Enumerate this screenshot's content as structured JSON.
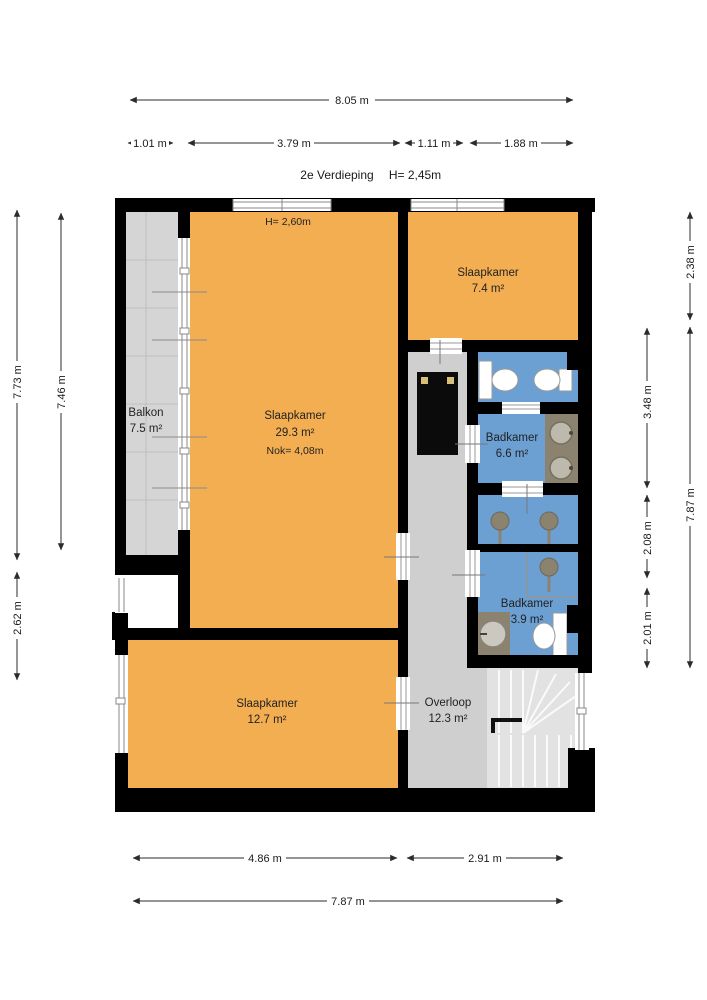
{
  "title": {
    "floor_label": "2e Verdieping",
    "ceiling_height": "H= 2,45m"
  },
  "dimensions": {
    "top_total": "8.05 m",
    "top_seg1": "1.01 m",
    "top_seg2": "3.79 m",
    "top_seg3": "1.11 m",
    "top_seg4": "1.88 m",
    "left_outer": "7.73 m",
    "left_inner": "7.46 m",
    "left_lower": "2.62 m",
    "right_top": "2.38 m",
    "right_outer": "7.87 m",
    "right_inner_top": "3.48 m",
    "right_inner_mid": "2.08 m",
    "right_inner_low": "2.01 m",
    "bottom_seg1": "4.86 m",
    "bottom_seg2": "2.91 m",
    "bottom_total": "7.87 m"
  },
  "rooms": {
    "balkon": {
      "name": "Balkon",
      "area": "7.5 m²"
    },
    "slaapkamer_groot": {
      "name": "Slaapkamer",
      "area": "29.3 m²",
      "ridge_height": "Nok= 4,08m",
      "ceiling_note": "H= 2,60m"
    },
    "slaapkamer_klein": {
      "name": "Slaapkamer",
      "area": "7.4 m²"
    },
    "badkamer_groot": {
      "name": "Badkamer",
      "area": "6.6 m²"
    },
    "badkamer_klein": {
      "name": "Badkamer",
      "area": "3.9 m²"
    },
    "slaapkamer_laag": {
      "name": "Slaapkamer",
      "area": "12.7 m²"
    },
    "overloop": {
      "name": "Overloop",
      "area": "12.3 m²"
    }
  },
  "colors": {
    "room_fill": "#F4AE52",
    "bathroom_fill": "#6CA0D2",
    "balcony_fill": "#D5D5D5",
    "hall_fill": "#CFCFCF",
    "stairs_fill": "#E2E2E2",
    "wall": "#000000",
    "counter": "#8C8270",
    "dimension": "#2B2B2B"
  }
}
